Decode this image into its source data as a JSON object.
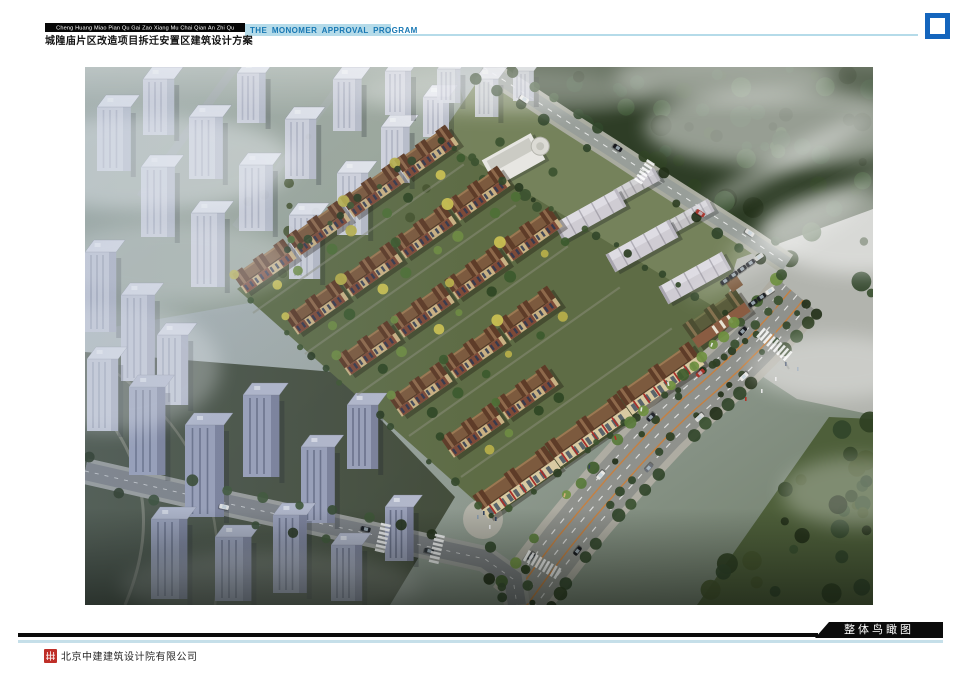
{
  "header": {
    "pinyin": "Cheng Huang Miao Pian Qu Gai Zao Xiang Mu Chai Qian An Zhi Qu",
    "program": "THE MONOMER APPROVAL PROGRAM",
    "title": "城隍庙片区改造项目拆迁安置区建筑设计方案"
  },
  "main_image": {
    "description": "整体鸟瞰图 aerial rendering of resettlement housing district"
  },
  "footer": {
    "caption": "整体鸟瞰图",
    "company": "北京中建建筑设计院有限公司"
  },
  "icons": {
    "fullscreen_icon": "four-corner-frame-brackets",
    "company_logo": "red-seal-emblem"
  },
  "colors": {
    "accent_blue": "#1465bd",
    "program_bar_bg": "#b5dbe9",
    "program_text": "#1878b4",
    "rule_blue": "#c5dfe9",
    "bar_black": "#0b0b0b",
    "logo_red": "#bf2f28"
  }
}
